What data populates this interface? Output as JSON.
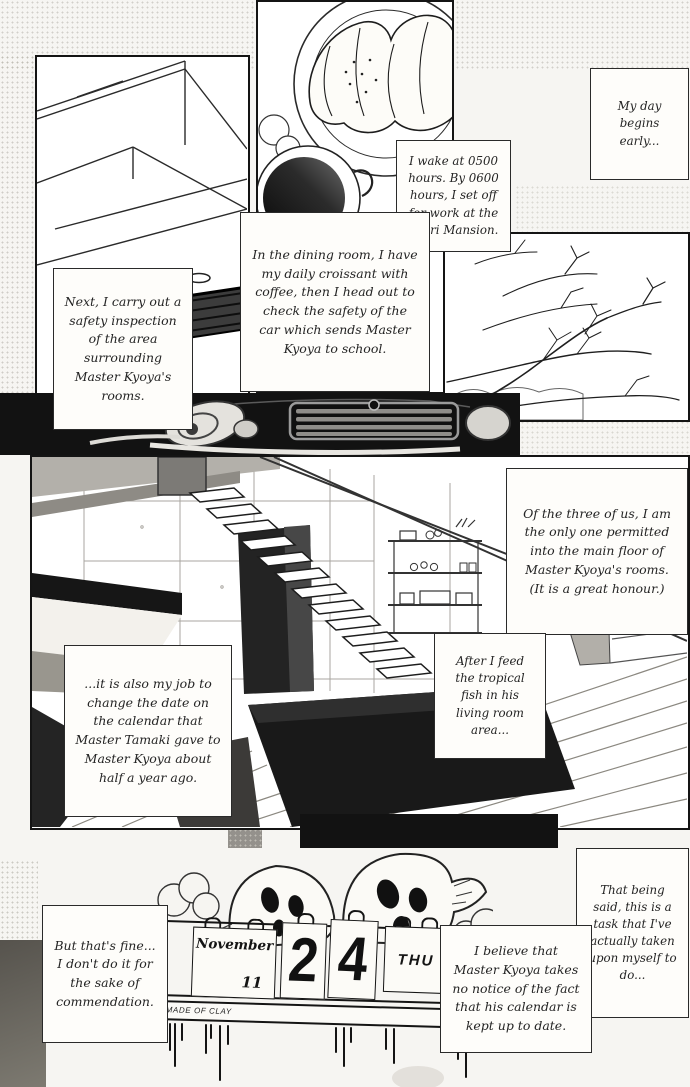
{
  "captions": {
    "my_day": "My day begins early...",
    "wake": "I wake at 0500 hours. By 0600 hours, I set off for work at the Otori Mansion.",
    "dining": "In the dining room, I have my daily croissant with coffee, then I head out to check the safety of the car which sends Master Kyoya to school.",
    "inspection": "Next, I carry out a safety inspection of the area surrounding Master Kyoya's rooms.",
    "three_of_us": "Of the three of us, I am the only one permitted into the main floor of Master Kyoya's rooms. (It is a great honour.)",
    "feed_fish": "After I feed the tropical fish in his living room area...",
    "calendar_job": "...it is also my job to change the date on the calendar that Master Tamaki gave to Master Kyoya about half a year ago.",
    "that_being_said": "That being said, this is a task that I've actually taken upon myself to do...",
    "believe": "I believe that Master Kyoya takes no notice of the fact that his calendar is kept up to date.",
    "thats_fine": "But that's fine... I don't do it for the sake of commendation."
  },
  "calendar": {
    "month": "November",
    "day_small": "11",
    "digit_tens": "2",
    "digit_ones": "4",
    "weekday": "THU",
    "maker_label": "MADE OF CLAY"
  },
  "colors": {
    "ink": "#141414",
    "paper": "#f6f5f2"
  }
}
